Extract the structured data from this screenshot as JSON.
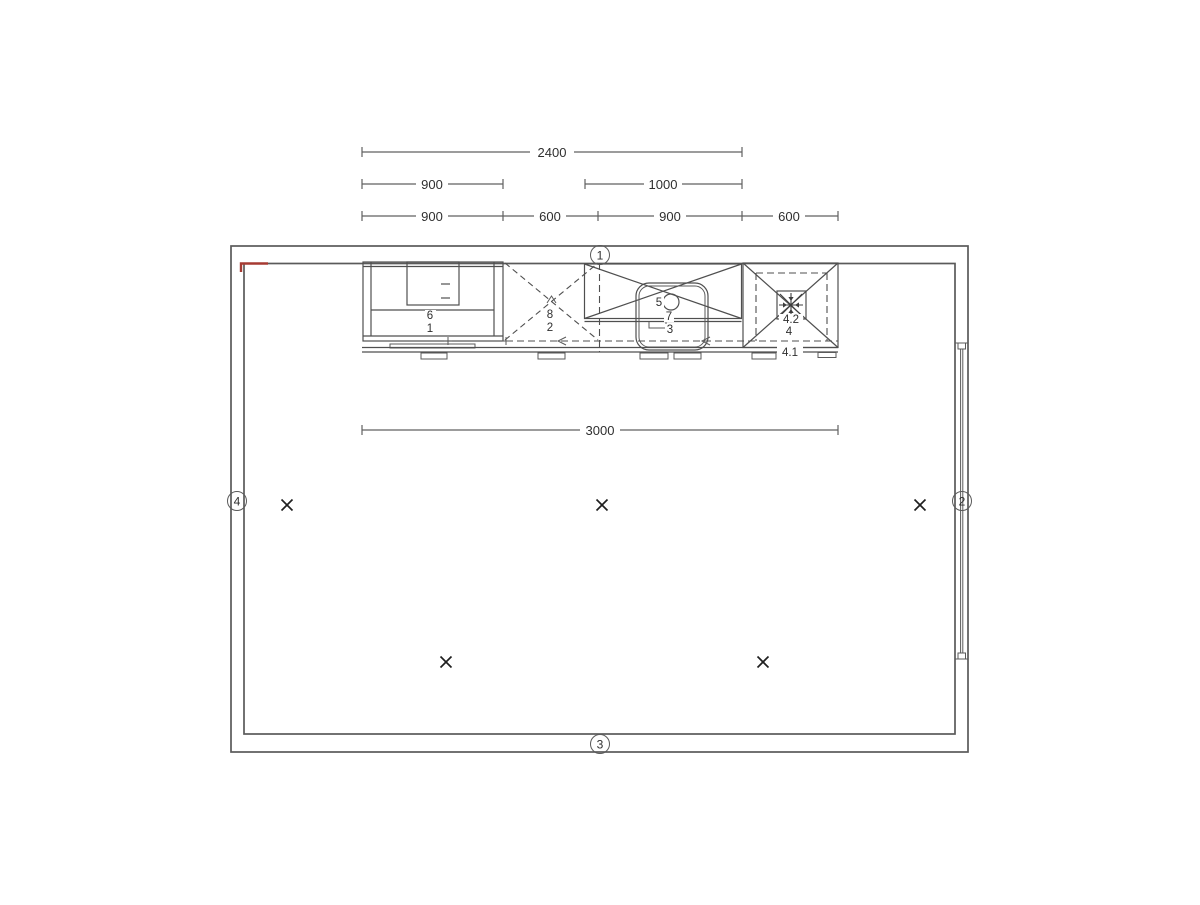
{
  "colors": {
    "line": "#606060",
    "cabinet_line": "#4f4f4f",
    "text": "#2f2f2f",
    "accent_red": "#a63a32"
  },
  "dimensions": {
    "row1": [
      {
        "value": "2400"
      }
    ],
    "row2": [
      {
        "value": "900"
      },
      {
        "value": "1000"
      }
    ],
    "row3": [
      {
        "value": "900"
      },
      {
        "value": "600"
      },
      {
        "value": "900"
      },
      {
        "value": "600"
      }
    ],
    "mid": {
      "value": "3000"
    }
  },
  "wall_markers": {
    "top": "1",
    "right": "2",
    "bottom": "3",
    "left": "4"
  },
  "fixtures": {
    "range": {
      "upper": "6",
      "lower": "1"
    },
    "dishwasher": {
      "upper": "8",
      "lower": "2"
    },
    "sink": {
      "tap": "5",
      "basin": "7",
      "drain": "3"
    },
    "extractor": {
      "fan": "4.2",
      "unit": "4",
      "base": "4.1"
    }
  }
}
